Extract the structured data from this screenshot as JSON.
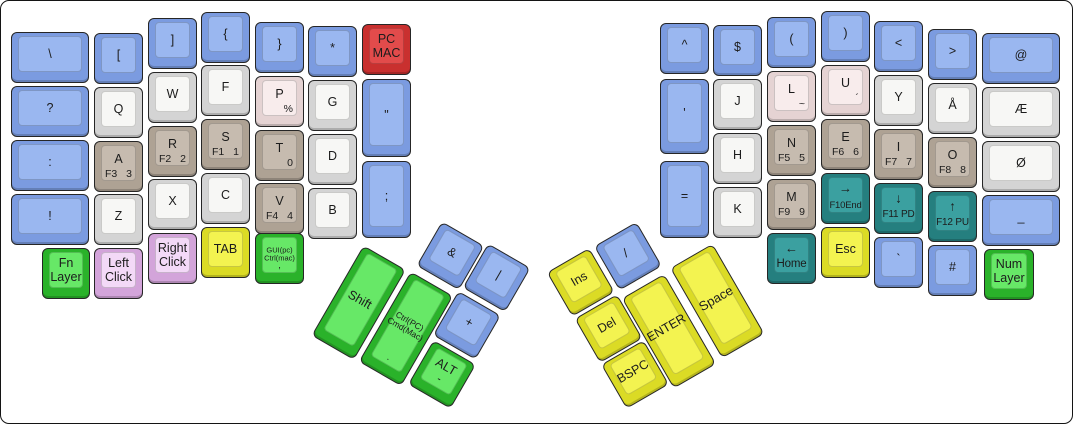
{
  "palette": {
    "blue": {
      "outer": "#7B9BE0",
      "inner": "#9AB7F0"
    },
    "white": {
      "outer": "#D4D4D4",
      "inner": "#F7F7F5"
    },
    "tan": {
      "outer": "#AEA294",
      "inner": "#C6BBAF"
    },
    "pink": {
      "outer": "#E5D3D3",
      "inner": "#F8ECEC"
    },
    "red": {
      "outer": "#C9302F",
      "inner": "#E24B4B"
    },
    "green": {
      "outer": "#2AB22A",
      "inner": "#67E867"
    },
    "lavender": {
      "outer": "#D3A4DA",
      "inner": "#F3D9F7"
    },
    "yellow": {
      "outer": "#DBDB25",
      "inner": "#F3F350"
    },
    "teal": {
      "outer": "#257F7F",
      "inner": "#3BA0A0"
    }
  },
  "keys": [
    {
      "name": "key-backslash",
      "x": 10,
      "y": 31,
      "w": 78,
      "h": 51,
      "color": "blue",
      "main": "\\"
    },
    {
      "name": "key-question",
      "x": 10,
      "y": 85,
      "w": 78,
      "h": 51,
      "color": "blue",
      "main": "?"
    },
    {
      "name": "key-colon",
      "x": 10,
      "y": 139,
      "w": 78,
      "h": 51,
      "color": "blue",
      "main": ":"
    },
    {
      "name": "key-exclaim",
      "x": 10,
      "y": 193,
      "w": 78,
      "h": 51,
      "color": "blue",
      "main": "!"
    },
    {
      "name": "key-left-bracket",
      "x": 93,
      "y": 32,
      "w": 49,
      "h": 51,
      "color": "blue",
      "main": "["
    },
    {
      "name": "key-q",
      "x": 93,
      "y": 86,
      "w": 49,
      "h": 51,
      "color": "white",
      "main": "Q"
    },
    {
      "name": "key-a",
      "x": 93,
      "y": 140,
      "w": 49,
      "h": 51,
      "color": "tan",
      "main": "A",
      "bl": "F3",
      "br": "3"
    },
    {
      "name": "key-z",
      "x": 93,
      "y": 193,
      "w": 49,
      "h": 51,
      "color": "white",
      "main": "Z"
    },
    {
      "name": "key-fn-layer",
      "x": 41,
      "y": 247,
      "w": 48,
      "h": 51,
      "color": "green",
      "lines": [
        "Fn",
        "Layer"
      ]
    },
    {
      "name": "key-left-click",
      "x": 93,
      "y": 247,
      "w": 49,
      "h": 51,
      "color": "lavender",
      "lines": [
        "Left",
        "Click"
      ]
    },
    {
      "name": "key-right-bracket",
      "x": 147,
      "y": 17,
      "w": 49,
      "h": 51,
      "color": "blue",
      "main": "]"
    },
    {
      "name": "key-w",
      "x": 147,
      "y": 71,
      "w": 49,
      "h": 51,
      "color": "white",
      "main": "W"
    },
    {
      "name": "key-r",
      "x": 147,
      "y": 125,
      "w": 49,
      "h": 51,
      "color": "tan",
      "main": "R",
      "bl": "F2",
      "br": "2"
    },
    {
      "name": "key-x",
      "x": 147,
      "y": 178,
      "w": 49,
      "h": 51,
      "color": "white",
      "main": "X"
    },
    {
      "name": "key-right-click",
      "x": 147,
      "y": 232,
      "w": 49,
      "h": 51,
      "color": "lavender",
      "lines": [
        "Right",
        "Click"
      ]
    },
    {
      "name": "key-left-brace",
      "x": 200,
      "y": 11,
      "w": 49,
      "h": 51,
      "color": "blue",
      "main": "{"
    },
    {
      "name": "key-f",
      "x": 200,
      "y": 64,
      "w": 49,
      "h": 51,
      "color": "white",
      "main": "F"
    },
    {
      "name": "key-s",
      "x": 200,
      "y": 118,
      "w": 49,
      "h": 51,
      "color": "tan",
      "main": "S",
      "bl": "F1",
      "br": "1"
    },
    {
      "name": "key-c",
      "x": 200,
      "y": 172,
      "w": 49,
      "h": 51,
      "color": "white",
      "main": "C"
    },
    {
      "name": "key-tab",
      "x": 200,
      "y": 226,
      "w": 49,
      "h": 51,
      "color": "yellow",
      "main": "TAB"
    },
    {
      "name": "key-right-brace",
      "x": 254,
      "y": 21,
      "w": 49,
      "h": 51,
      "color": "blue",
      "main": "}"
    },
    {
      "name": "key-p",
      "x": 254,
      "y": 75,
      "w": 49,
      "h": 51,
      "color": "pink",
      "main": "P",
      "br": "%"
    },
    {
      "name": "key-t",
      "x": 254,
      "y": 129,
      "w": 49,
      "h": 51,
      "color": "tan",
      "main": "T",
      "br": "0"
    },
    {
      "name": "key-v",
      "x": 254,
      "y": 182,
      "w": 49,
      "h": 51,
      "color": "tan",
      "main": "V",
      "bl": "F4",
      "br": "4"
    },
    {
      "name": "key-gui",
      "x": 254,
      "y": 232,
      "w": 49,
      "h": 51,
      "color": "green",
      "lines": [
        "GUI(pc)",
        "Ctrl(mac)"
      ],
      "fs": 7.5,
      "sub": ","
    },
    {
      "name": "key-asterisk",
      "x": 307,
      "y": 25,
      "w": 49,
      "h": 51,
      "color": "blue",
      "main": "*"
    },
    {
      "name": "key-g",
      "x": 307,
      "y": 79,
      "w": 49,
      "h": 51,
      "color": "white",
      "main": "G"
    },
    {
      "name": "key-d",
      "x": 307,
      "y": 133,
      "w": 49,
      "h": 51,
      "color": "white",
      "main": "D"
    },
    {
      "name": "key-b",
      "x": 307,
      "y": 187,
      "w": 49,
      "h": 51,
      "color": "white",
      "main": "B"
    },
    {
      "name": "key-pc-mac",
      "x": 361,
      "y": 23,
      "w": 49,
      "h": 51,
      "color": "red",
      "lines": [
        "PC",
        "MAC"
      ]
    },
    {
      "name": "key-double-quote",
      "x": 361,
      "y": 78,
      "w": 49,
      "h": 78,
      "color": "blue",
      "main": "\""
    },
    {
      "name": "key-semicolon",
      "x": 361,
      "y": 160,
      "w": 49,
      "h": 77,
      "color": "blue",
      "main": ";"
    },
    {
      "name": "key-caret",
      "x": 659,
      "y": 22,
      "w": 49,
      "h": 51,
      "color": "blue",
      "main": "^"
    },
    {
      "name": "key-apostrophe",
      "x": 659,
      "y": 78,
      "w": 49,
      "h": 75,
      "color": "blue",
      "main": "'"
    },
    {
      "name": "key-equals",
      "x": 659,
      "y": 160,
      "w": 49,
      "h": 77,
      "color": "blue",
      "main": "="
    },
    {
      "name": "key-dollar",
      "x": 712,
      "y": 24,
      "w": 49,
      "h": 51,
      "color": "blue",
      "main": "$"
    },
    {
      "name": "key-j",
      "x": 712,
      "y": 78,
      "w": 49,
      "h": 51,
      "color": "white",
      "main": "J"
    },
    {
      "name": "key-h",
      "x": 712,
      "y": 132,
      "w": 49,
      "h": 51,
      "color": "white",
      "main": "H"
    },
    {
      "name": "key-k",
      "x": 712,
      "y": 186,
      "w": 49,
      "h": 51,
      "color": "white",
      "main": "K"
    },
    {
      "name": "key-left-paren",
      "x": 766,
      "y": 16,
      "w": 49,
      "h": 51,
      "color": "blue",
      "main": "("
    },
    {
      "name": "key-l",
      "x": 766,
      "y": 70,
      "w": 49,
      "h": 51,
      "color": "pink",
      "main": "L",
      "br": "~"
    },
    {
      "name": "key-n",
      "x": 766,
      "y": 124,
      "w": 49,
      "h": 51,
      "color": "tan",
      "main": "N",
      "bl": "F5",
      "br": "5"
    },
    {
      "name": "key-m",
      "x": 766,
      "y": 178,
      "w": 49,
      "h": 51,
      "color": "tan",
      "main": "M",
      "bl": "F9",
      "br": "9"
    },
    {
      "name": "key-home",
      "x": 766,
      "y": 232,
      "w": 49,
      "h": 51,
      "color": "teal",
      "main": "←",
      "arrow": true,
      "sub": "Home",
      "subfs": 11.5
    },
    {
      "name": "key-right-paren",
      "x": 820,
      "y": 10,
      "w": 49,
      "h": 51,
      "color": "blue",
      "main": ")"
    },
    {
      "name": "key-u",
      "x": 820,
      "y": 64,
      "w": 49,
      "h": 51,
      "color": "pink",
      "main": "U",
      "br": "´"
    },
    {
      "name": "key-e",
      "x": 820,
      "y": 118,
      "w": 49,
      "h": 51,
      "color": "tan",
      "main": "E",
      "bl": "F6",
      "br": "6"
    },
    {
      "name": "key-arrow-right",
      "x": 820,
      "y": 172,
      "w": 49,
      "h": 51,
      "color": "teal",
      "main": "→",
      "arrow": true,
      "sub": "F10End",
      "subfs": 9.5
    },
    {
      "name": "key-esc",
      "x": 820,
      "y": 226,
      "w": 49,
      "h": 51,
      "color": "yellow",
      "main": "Esc"
    },
    {
      "name": "key-less-than",
      "x": 873,
      "y": 20,
      "w": 49,
      "h": 51,
      "color": "blue",
      "main": "<"
    },
    {
      "name": "key-y",
      "x": 873,
      "y": 74,
      "w": 49,
      "h": 51,
      "color": "white",
      "main": "Y"
    },
    {
      "name": "key-i",
      "x": 873,
      "y": 128,
      "w": 49,
      "h": 51,
      "color": "tan",
      "main": "I",
      "bl": "F7",
      "br": "7"
    },
    {
      "name": "key-arrow-down",
      "x": 873,
      "y": 182,
      "w": 49,
      "h": 51,
      "color": "teal",
      "main": "↓",
      "arrow": true,
      "sub": "F11 PD",
      "subfs": 10
    },
    {
      "name": "key-backtick",
      "x": 873,
      "y": 236,
      "w": 49,
      "h": 51,
      "color": "blue",
      "main": "`"
    },
    {
      "name": "key-greater-than",
      "x": 927,
      "y": 28,
      "w": 49,
      "h": 51,
      "color": "blue",
      "main": ">"
    },
    {
      "name": "key-aring",
      "x": 927,
      "y": 82,
      "w": 49,
      "h": 51,
      "color": "white",
      "main": "Å"
    },
    {
      "name": "key-o",
      "x": 927,
      "y": 136,
      "w": 49,
      "h": 51,
      "color": "tan",
      "main": "O",
      "bl": "F8",
      "br": "8"
    },
    {
      "name": "key-arrow-up",
      "x": 927,
      "y": 190,
      "w": 49,
      "h": 51,
      "color": "teal",
      "main": "↑",
      "arrow": true,
      "sub": "F12 PU",
      "subfs": 10
    },
    {
      "name": "key-hash",
      "x": 927,
      "y": 244,
      "w": 49,
      "h": 51,
      "color": "blue",
      "main": "#"
    },
    {
      "name": "key-at",
      "x": 981,
      "y": 32,
      "w": 78,
      "h": 51,
      "color": "blue",
      "main": "@"
    },
    {
      "name": "key-ae",
      "x": 981,
      "y": 86,
      "w": 78,
      "h": 51,
      "color": "white",
      "main": "Æ"
    },
    {
      "name": "key-oslash",
      "x": 981,
      "y": 140,
      "w": 78,
      "h": 51,
      "color": "white",
      "main": "Ø"
    },
    {
      "name": "key-underscore",
      "x": 981,
      "y": 194,
      "w": 78,
      "h": 51,
      "color": "blue",
      "main": "_"
    },
    {
      "name": "key-num-layer",
      "x": 983,
      "y": 248,
      "w": 50,
      "h": 51,
      "color": "green",
      "lines": [
        "Num",
        "Layer"
      ]
    }
  ],
  "clusters": {
    "left": {
      "x": 391,
      "y": 187,
      "deg": 30,
      "keys": [
        {
          "name": "key-ampersand",
          "x": 59.7,
          "y": 4.3,
          "w": 49,
          "h": 51,
          "color": "blue",
          "main": "&"
        },
        {
          "name": "key-pipe",
          "x": 111.4,
          "y": 0,
          "w": 49,
          "h": 51,
          "color": "blue",
          "main": "|"
        },
        {
          "name": "key-shift",
          "x": 3.5,
          "y": 64,
          "w": 49,
          "h": 104,
          "color": "green",
          "main": "Shift"
        },
        {
          "name": "key-ctrl-cmd",
          "x": 57.5,
          "y": 63,
          "w": 49,
          "h": 104,
          "color": "green",
          "lines": [
            "Ctrl(PC)",
            "Cmd(Mac)"
          ],
          "fs": 8.5,
          "sub": "."
        },
        {
          "name": "key-plus",
          "x": 109.4,
          "y": 56.4,
          "w": 49,
          "h": 51,
          "color": "blue",
          "main": "+"
        },
        {
          "name": "key-alt",
          "x": 111.8,
          "y": 110.5,
          "w": 49,
          "h": 51,
          "color": "green",
          "main": "ALT",
          "sub": "-",
          "subfs": 11
        }
      ]
    },
    "right": {
      "x": 516,
      "y": 284,
      "deg": -30,
      "keys": [
        {
          "name": "key-ins",
          "x": 32.3,
          "y": 3.6,
          "w": 49,
          "h": 51,
          "color": "yellow",
          "main": "Ins"
        },
        {
          "name": "key-slash",
          "x": 85.5,
          "y": 5.4,
          "w": 49,
          "h": 51,
          "color": "blue",
          "main": "/"
        },
        {
          "name": "key-del",
          "x": 33.1,
          "y": 58.3,
          "w": 49,
          "h": 51,
          "color": "yellow",
          "main": "Del"
        },
        {
          "name": "key-enter",
          "x": 83.5,
          "y": 63.9,
          "w": 49,
          "h": 104,
          "color": "yellow",
          "main": "ENTER"
        },
        {
          "name": "key-space",
          "x": 141,
          "y": 62.4,
          "w": 49,
          "h": 104,
          "color": "yellow",
          "main": "Space",
          "fs": 13
        },
        {
          "name": "key-bspc",
          "x": 32.6,
          "y": 111.1,
          "w": 49,
          "h": 51,
          "color": "yellow",
          "main": "BSPC"
        }
      ]
    }
  }
}
